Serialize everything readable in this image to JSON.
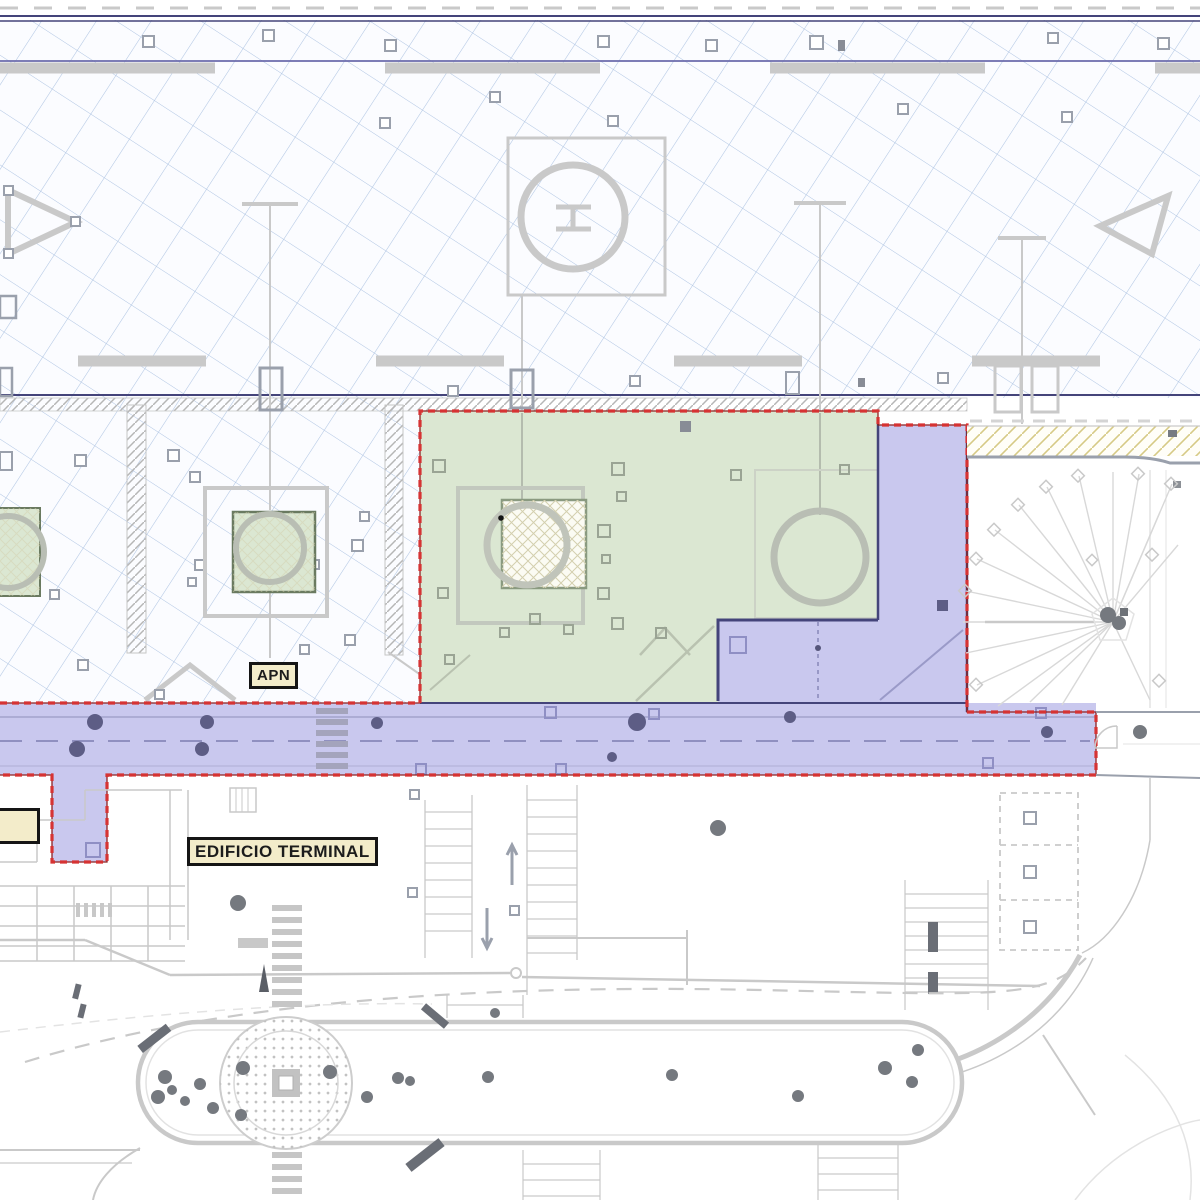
{
  "labels": {
    "apn": "APN",
    "edificio_terminal": "EDIFICIO TERMINAL"
  },
  "colors": {
    "hatch-blue": "#9db8dc",
    "hatch-gray": "#b6b6b6",
    "line-navy": "#44447a",
    "line-blue": "#6b6bac",
    "boundary-red": "#d63333",
    "boundary-red-dark": "#8e1f1f",
    "zone-green": "#dbe7d2",
    "zone-green-border": "#6a7a60",
    "zone-purple": "#c9c8ee",
    "purple-line": "#8f8fc4",
    "road-tree": "#5d5d85",
    "tree-gray": "#75797f",
    "cad-gray": "#c9c9c9",
    "cad-gray-dark": "#9aa0ac",
    "cad-gray-light": "#e3e3e3",
    "yellow-hatch": "#d6ca86",
    "label-bg": "#f3ecca",
    "label-border": "#151515",
    "label-text": "#1c1c1c"
  }
}
